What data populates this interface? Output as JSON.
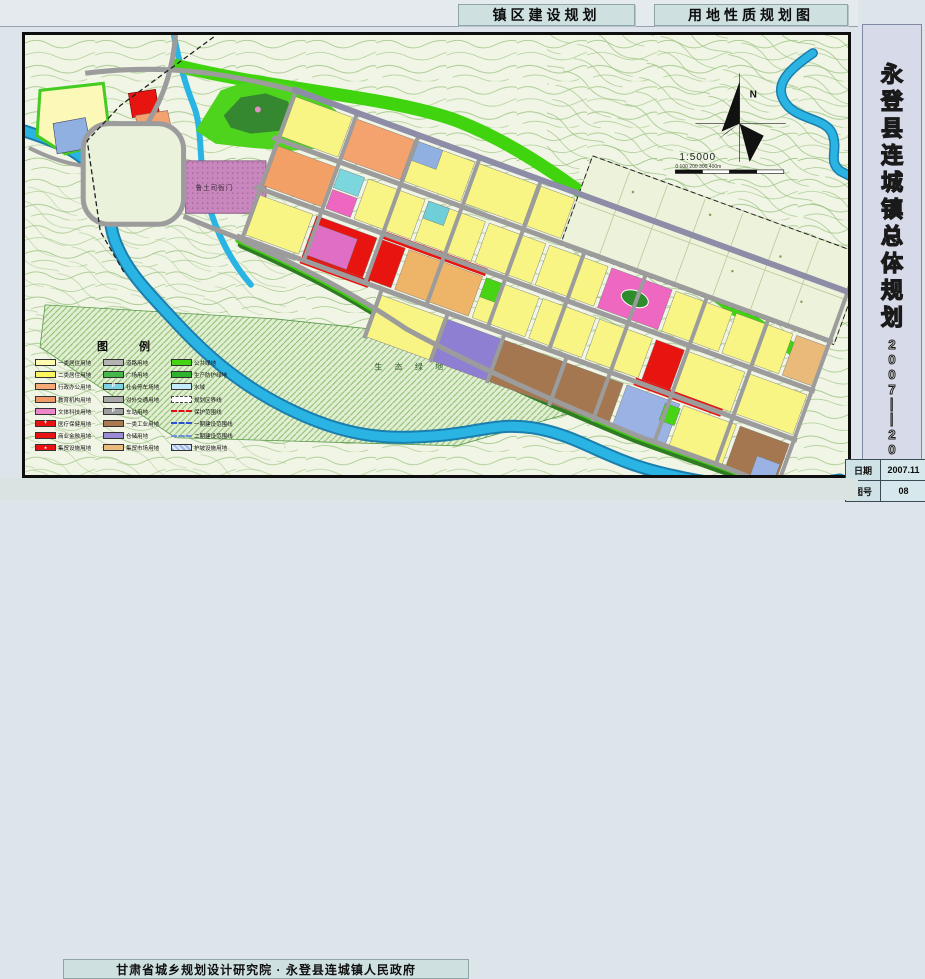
{
  "header": {
    "title_left": "镇区建设规划",
    "title_right": "用地性质规划图"
  },
  "sidebar": {
    "title": "永登县连城镇总体规划",
    "period": "2007——2020",
    "info": [
      {
        "label": "日期",
        "value": "2007.11"
      },
      {
        "label": "图号",
        "value": "08"
      }
    ]
  },
  "footer": {
    "credit": "甘肃省城乡规划设计研究院 · 永登县连城镇人民政府"
  },
  "map": {
    "north_label": "N",
    "scale_text": "1:5000",
    "scalebar": "0  100  200  300  400m",
    "labels": {
      "historic_site": "鲁土司衙门",
      "eco_green": "生 态 绿 地"
    },
    "colors": {
      "topo_bg": "#f1f5e6",
      "contour": "#a5c98b",
      "river": "#2ab4e4",
      "green_band": "#3fd40e",
      "residential": "#f9f584",
      "commercial_red": "#e81410",
      "road_gray": "#9c9c9c"
    }
  },
  "legend": {
    "title": "图  例",
    "columns": [
      {
        "items": [
          {
            "label": "一类居住用地",
            "color": "#fdfbb0"
          },
          {
            "label": "二类居住用地",
            "color": "#fbf55e"
          },
          {
            "label": "行政办公用地",
            "color": "#f5aa78"
          },
          {
            "label": "教育机构用地",
            "color": "#f09a6a"
          },
          {
            "label": "文体科技用地",
            "color": "#ef86c7"
          },
          {
            "label": "医疗保健用地",
            "color": "#e81212",
            "style": "sw-cross"
          },
          {
            "label": "商业金融用地",
            "color": "#e81212"
          },
          {
            "label": "集贸设施用地",
            "color": "#e81212",
            "style": "sw-star"
          }
        ]
      },
      {
        "items": [
          {
            "label": "道路用地",
            "color": "#b3b3b3"
          },
          {
            "label": "广场用地",
            "color": "#45b84a"
          },
          {
            "label": "社会停车场地",
            "color": "#7fd2e0",
            "style": "sw-p"
          },
          {
            "label": "对外交通用地",
            "color": "#a9a9a9"
          },
          {
            "label": "车站用地",
            "color": "#9f9f9f",
            "style": "sw-p"
          },
          {
            "label": "一类工业用地",
            "color": "#a97a52"
          },
          {
            "label": "仓储用地",
            "color": "#9b8ad6"
          },
          {
            "label": "集贸市场用地",
            "color": "#e9bc7d"
          }
        ]
      },
      {
        "items": [
          {
            "label": "公共绿地",
            "color": "#45d414"
          },
          {
            "label": "生产防护绿地",
            "color": "#2db32d"
          },
          {
            "label": "水域",
            "color": "#c3ecf8"
          },
          {
            "label": "规划区界线",
            "style": "sw-dashed"
          },
          {
            "label": "保护范围线",
            "style": "sw-line-red"
          },
          {
            "label": "一期建设范围线",
            "style": "sw-line-blue"
          },
          {
            "label": "二期建设范围线",
            "style": "sw-line-blue2"
          },
          {
            "label": "护坡设施用地",
            "style": "sw-hatch"
          }
        ]
      }
    ]
  }
}
